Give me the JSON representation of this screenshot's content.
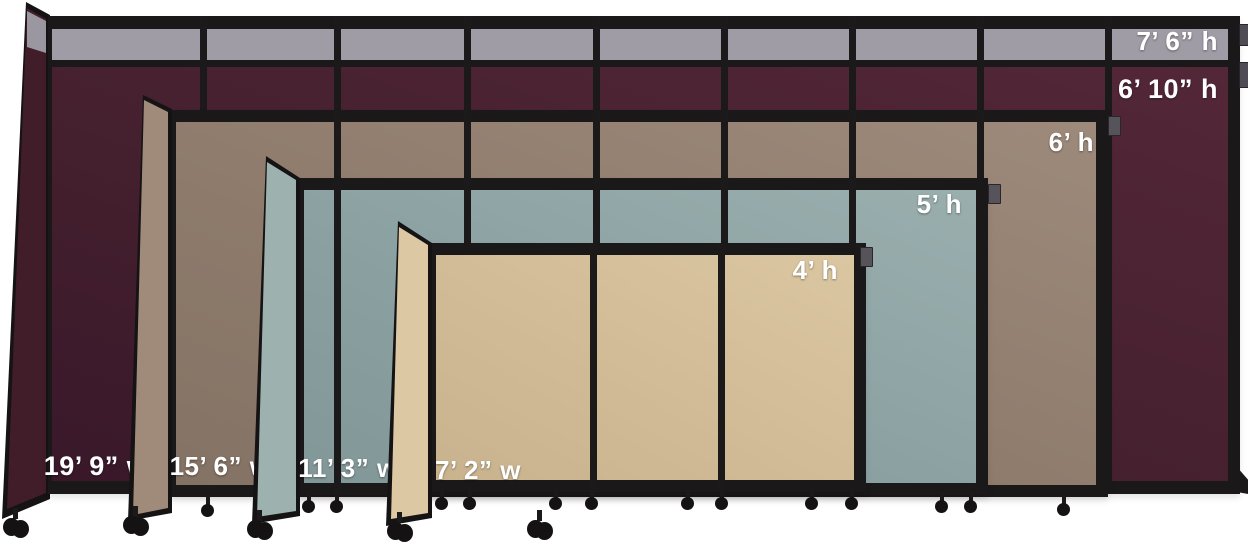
{
  "title": "Room divider size comparison",
  "background_color": "#ffffff",
  "frame_color": "#1b1819",
  "top_panel_color": "#a09ca6",
  "dividers": [
    {
      "name": "burgundy",
      "fabric_color": "#48202e",
      "top_height_label": "7’ 6” h",
      "height_label": "6’ 10” h",
      "width_label": "19’ 9” w"
    },
    {
      "name": "mocha",
      "fabric_color": "#8f7c6c",
      "height_label": "6’ h",
      "width_label": "15’ 6” w"
    },
    {
      "name": "slate-blue",
      "fabric_color": "#8da1a1",
      "height_label": "5’ h",
      "width_label": "11’ 3” w"
    },
    {
      "name": "tan",
      "fabric_color": "#d2bc97",
      "height_label": "4’ h",
      "width_label": "7’ 2” w"
    }
  ]
}
